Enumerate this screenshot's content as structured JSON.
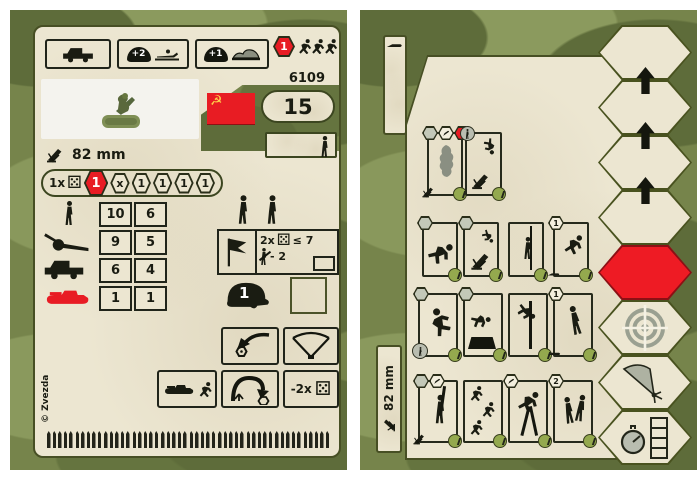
{
  "front_card": {
    "catalog_number": "6109",
    "points_value": "15",
    "weapon_label": "82 mm",
    "top_bonuses": {
      "entrench": "+2",
      "cover": "+1",
      "rout": "1"
    },
    "initiative_track": {
      "prefix": "1x",
      "current": "1",
      "cells": [
        "x",
        "1",
        "1",
        "1",
        "1"
      ]
    },
    "fire_table": {
      "rows": [
        {
          "target": "infantry",
          "close": "10",
          "far": "6"
        },
        {
          "target": "field-gun",
          "close": "9",
          "far": "5"
        },
        {
          "target": "truck",
          "close": "6",
          "far": "4"
        },
        {
          "target": "tank",
          "close": "1",
          "far": "1"
        }
      ]
    },
    "morale_check": {
      "dice": "2x",
      "threshold": "≤ 7",
      "penalty": "- 2"
    },
    "helmet_value": "1",
    "retreat_modifier": "-2x",
    "copyright": "© Zvezda"
  },
  "back_card": {
    "weapon_label": "82 mm",
    "badges": {
      "move_fire": "1",
      "move_dig": "1",
      "double_move": "2"
    }
  }
}
